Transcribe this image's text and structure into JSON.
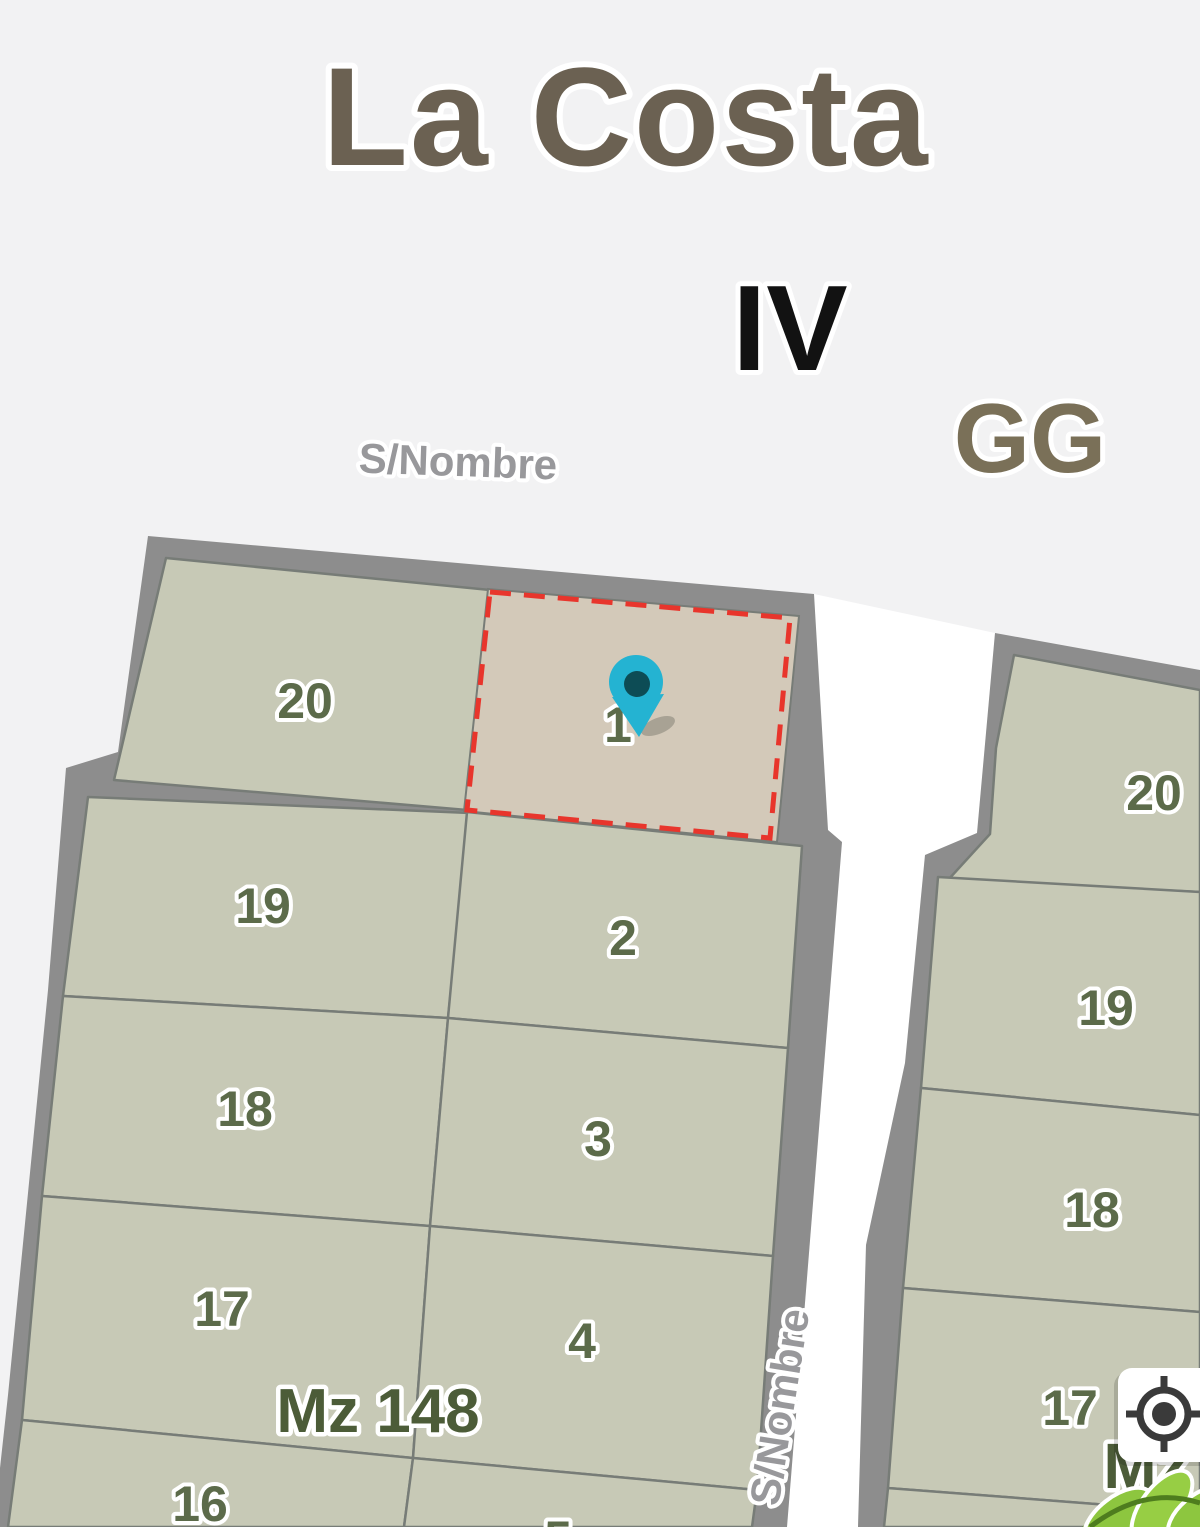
{
  "map": {
    "title": "La Costa",
    "labels": {
      "section_roman": "IV",
      "zone": "GG"
    },
    "streets": {
      "top_label": "S/Nombre",
      "side_label": "S/Nombre",
      "label_color": "#98989b",
      "street_color": "#ffffff"
    },
    "block_left": {
      "label": "Mz 148",
      "column_left": [
        "20",
        "19",
        "18",
        "17",
        "16"
      ],
      "column_right": [
        "1",
        "2",
        "3",
        "4",
        "5"
      ]
    },
    "block_right": {
      "label": "Mz",
      "column": [
        "20",
        "19",
        "18",
        "17"
      ]
    },
    "selected_parcel": {
      "number": "1",
      "fill_color": "#d3c9b9",
      "outline_color": "#e8352c"
    },
    "marker": {
      "kind": "location-pin",
      "color": "#24b3d2",
      "dot_color": "#0d4c55"
    },
    "colors": {
      "background": "#f2f2f3",
      "block_border": "#8d8d8d",
      "parcel_fill": "#c7c9b6",
      "parcel_number": "#5c6b4a",
      "block_label": "#4c5c38",
      "title": "#6b6152",
      "vegetation": "#8dc63f"
    }
  },
  "controls": {
    "locate_button": {
      "icon": "crosshair-locate",
      "background": "#ffffff",
      "icon_color": "#3a3a3a"
    }
  }
}
